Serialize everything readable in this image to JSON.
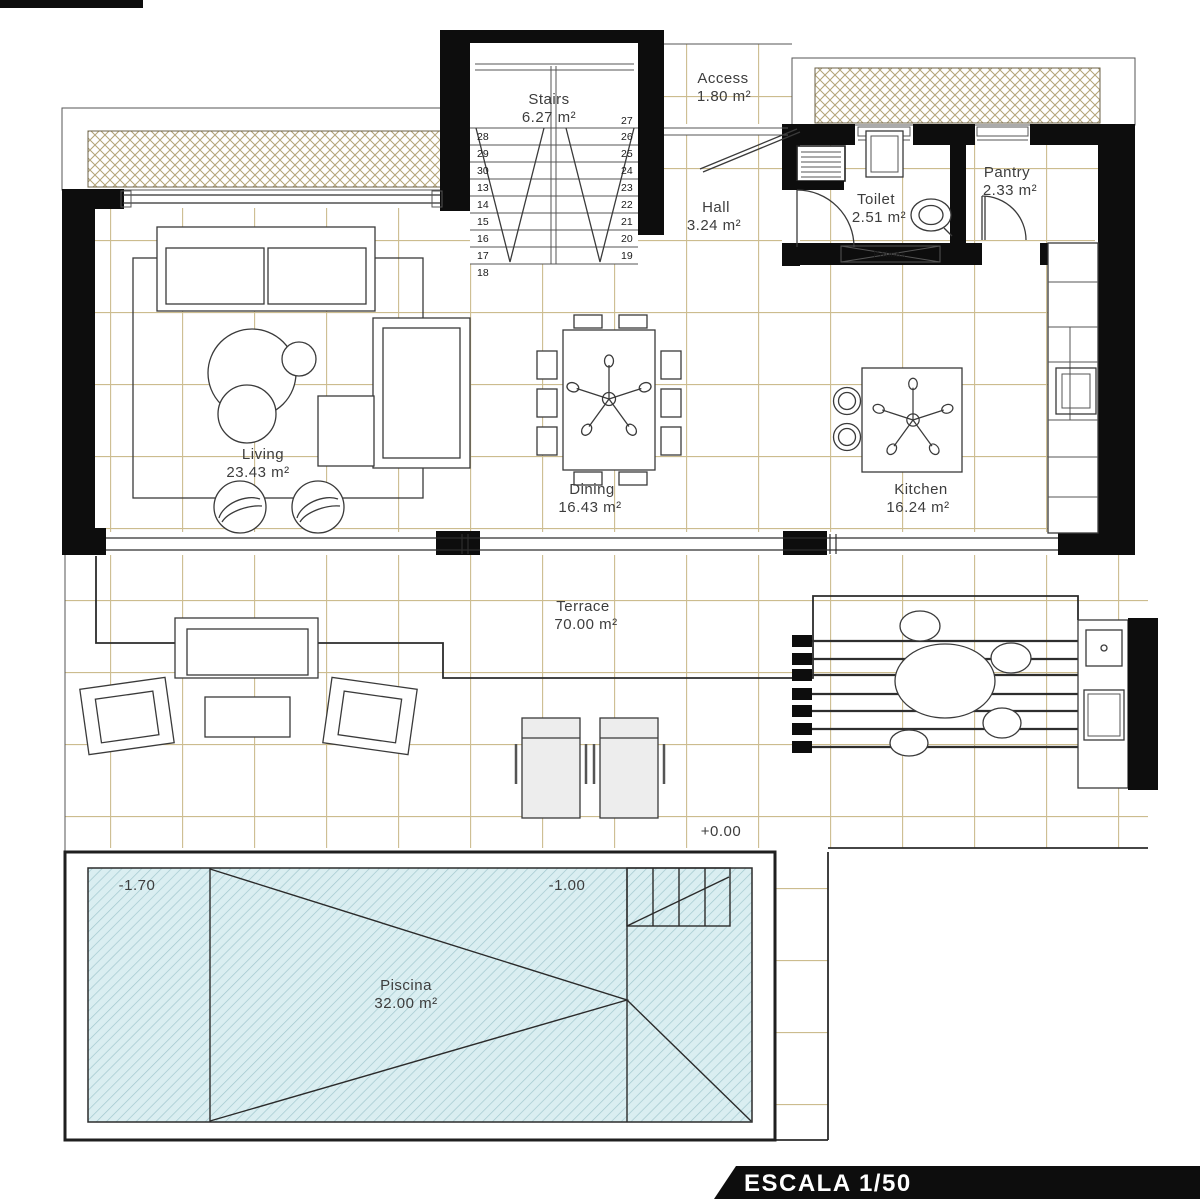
{
  "plan": {
    "rooms": {
      "stairs": {
        "name": "Stairs",
        "area": "6.27 m²"
      },
      "access": {
        "name": "Access",
        "area": "1.80 m²"
      },
      "hall": {
        "name": "Hall",
        "area": "3.24 m²"
      },
      "toilet": {
        "name": "Toilet",
        "area": "2.51 m²"
      },
      "pantry": {
        "name": "Pantry",
        "area": "2.33 m²"
      },
      "living": {
        "name": "Living",
        "area": "23.43 m²"
      },
      "dining": {
        "name": "Dining",
        "area": "16.43 m²"
      },
      "kitchen": {
        "name": "Kitchen",
        "area": "16.24 m²"
      },
      "terrace": {
        "name": "Terrace",
        "area": "70.00 m²"
      },
      "piscina": {
        "name": "Piscina",
        "area": "32.00 m²"
      }
    },
    "levels": {
      "terrace_level": "+0.00",
      "pool_deep_end": "-1.70",
      "pool_shallow_end": "-1.00"
    },
    "stairs_numbers": {
      "left": [
        "28",
        "29",
        "30",
        "13",
        "14",
        "15",
        "16",
        "17"
      ],
      "bottom_left": "18",
      "right": [
        "27",
        "26",
        "25",
        "24",
        "23",
        "22",
        "21",
        "20",
        "19"
      ]
    },
    "closet_label": "Palmas",
    "scale_banner": "ESCALA 1/50",
    "colors": {
      "wall": "#0d0d0d",
      "grid": "#ccbc8e",
      "hatch": "#b3a478",
      "pool_fill": "#daeef1",
      "pool_hatch": "#a2c8ce",
      "banner_bg": "#0d0d0d",
      "banner_text": "#ffffff",
      "label": "#3d3d3d"
    }
  }
}
